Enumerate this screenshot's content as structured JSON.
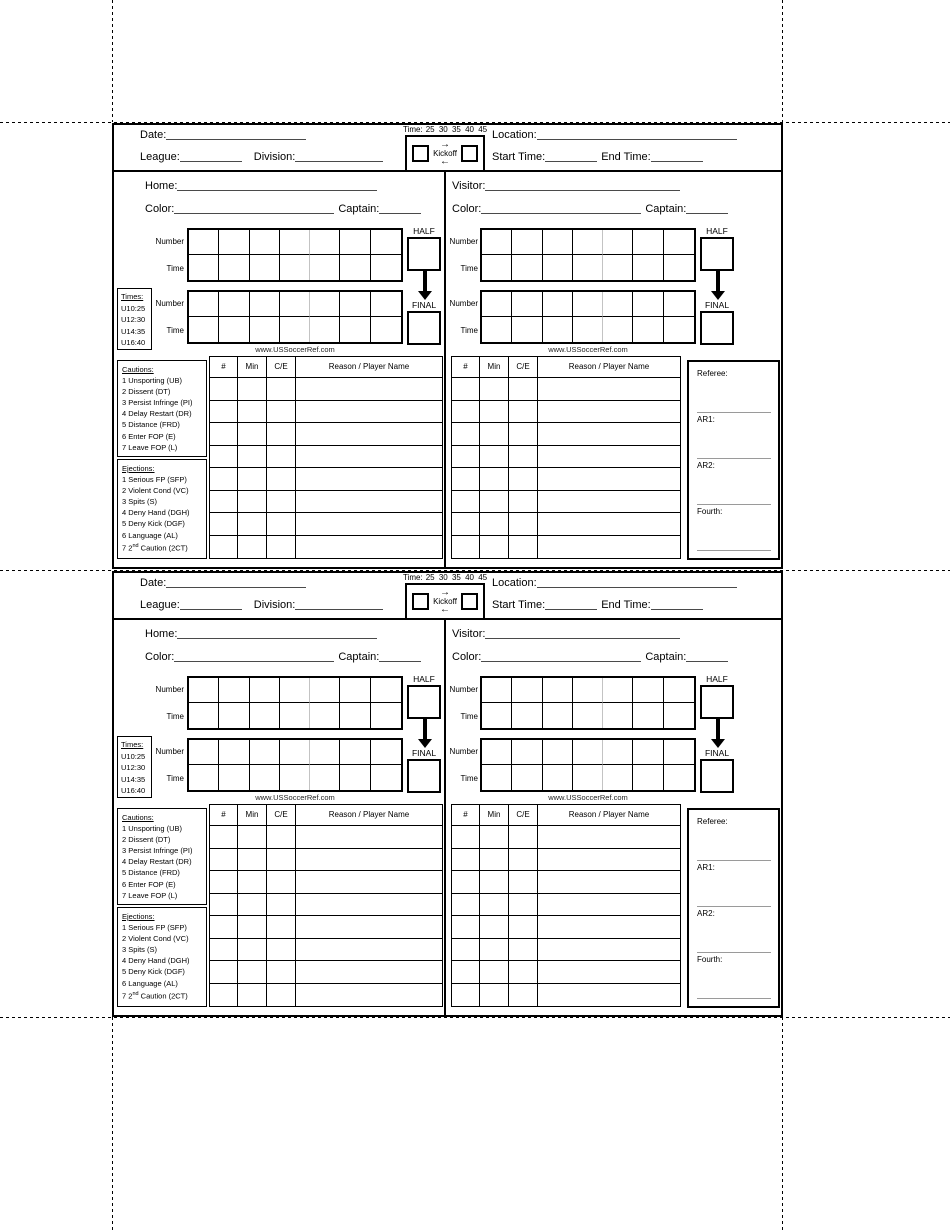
{
  "card": {
    "header": {
      "date_label": "Date:",
      "league_label": "League:",
      "division_label": "Division:",
      "location_label": "Location:",
      "start_time_label": "Start Time:",
      "end_time_label": "End Time:",
      "kickoff": {
        "time_label": "Time:",
        "time_options": "25  30  35  40  45",
        "label": "Kickoff",
        "arrow_right": "→",
        "arrow_left": "←"
      }
    },
    "teams": {
      "home_label": "Home:",
      "visitor_label": "Visitor:",
      "color_label": "Color:",
      "captain_label": "Captain:"
    },
    "score_grid": {
      "columns": 7,
      "number_label": "Number",
      "time_label": "Time",
      "half_label": "HALF",
      "final_label": "FINAL"
    },
    "times_box": {
      "title": "Times:",
      "entries": [
        "U10:25",
        "U12:30",
        "U14:35",
        "U16:40"
      ]
    },
    "website": "www.USSoccerRef.com",
    "cautions": {
      "title": "Cautions:",
      "items": [
        "1 Unsporting (UB)",
        "2 Dissent (DT)",
        "3 Persist Infringe (PI)",
        "4 Delay Restart (DR)",
        "5 Distance (FRD)",
        "6 Enter FOP (E)",
        "7 Leave FOP (L)"
      ]
    },
    "ejections": {
      "title": "Ejections:",
      "items": [
        "1 Serious FP (SFP)",
        "2 Violent Cond (VC)",
        "3 Spits (S)",
        "4 Deny Hand (DGH)",
        "5 Deny Kick (DGF)",
        "6 Language (AL)"
      ],
      "last_item": {
        "prefix": "7 2",
        "sup": "nd",
        "suffix": " Caution (2CT)"
      }
    },
    "misconduct_table": {
      "headers": [
        "#",
        "Min",
        "C/E",
        "Reason / Player Name"
      ],
      "row_count": 8
    },
    "officials": {
      "referee_label": "Referee:",
      "ar1_label": "AR1:",
      "ar2_label": "AR2:",
      "fourth_label": "Fourth:"
    }
  }
}
